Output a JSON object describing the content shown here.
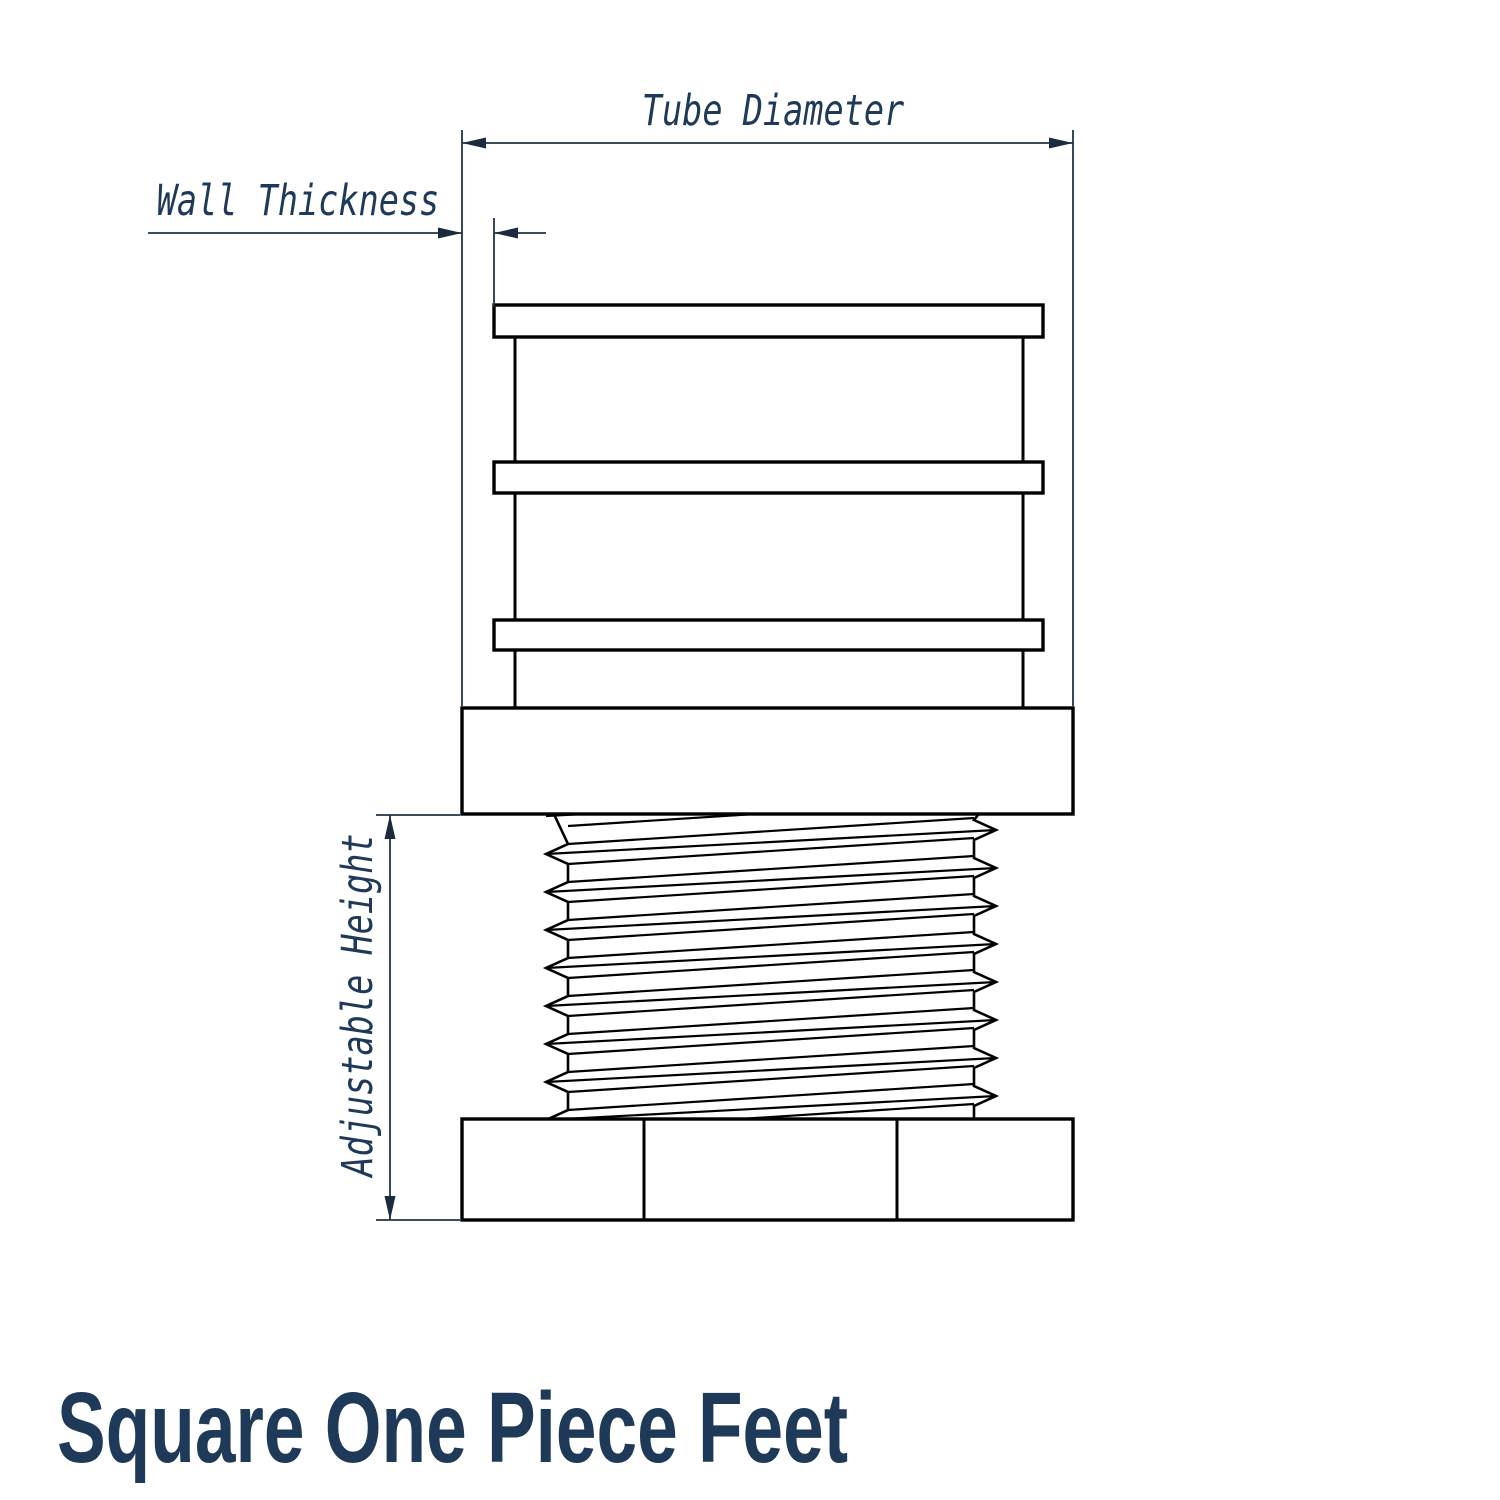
{
  "page": {
    "background": "#ffffff"
  },
  "title": {
    "text": "Square One Piece Feet",
    "color": "#1f3a58"
  },
  "drawing": {
    "part": "square-one-piece-adjustable-foot",
    "line_color": "#000000",
    "dimension_color": "#22334a",
    "arrow_color": "#1b2a3d",
    "label_color": "#1f3a58",
    "labels": {
      "tube_diameter": "Tube Diameter",
      "wall_thickness": "Wall Thickness",
      "adjustable_height": "Adjustable Height"
    }
  }
}
